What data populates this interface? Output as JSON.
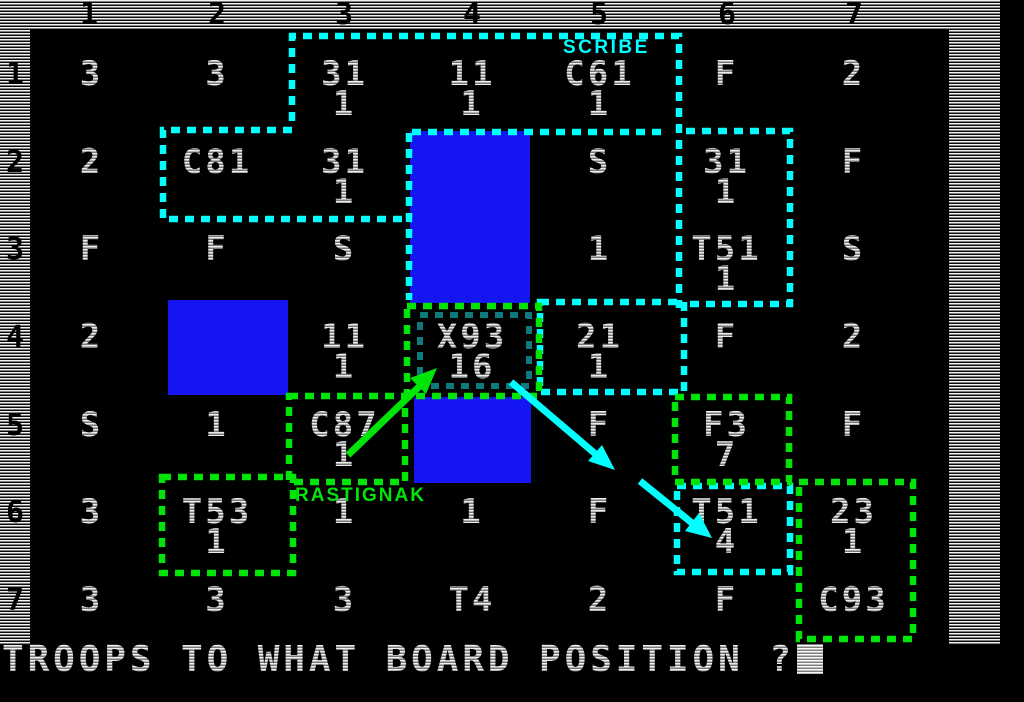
{
  "window": {
    "width": 1024,
    "height": 702
  },
  "game": {
    "prompt": "TROOPS TO WHAT BOARD POSITION ?",
    "cursor_visible": true
  },
  "board": {
    "column_labels": [
      "1",
      "2",
      "3",
      "4",
      "5",
      "6",
      "7"
    ],
    "row_labels": [
      "1",
      "2",
      "3",
      "4",
      "5",
      "6",
      "7"
    ],
    "cells": [
      [
        [
          "3"
        ],
        [
          "3"
        ],
        [
          "31",
          "1"
        ],
        [
          "11",
          "1"
        ],
        [
          "C61",
          "1"
        ],
        [
          "F"
        ],
        [
          "2"
        ]
      ],
      [
        [
          "2"
        ],
        [
          "C81"
        ],
        [
          "31",
          "1"
        ],
        [],
        [
          "S"
        ],
        [
          "31",
          "1"
        ],
        [
          "F"
        ]
      ],
      [
        [
          "F"
        ],
        [
          "F"
        ],
        [
          "S"
        ],
        [],
        [
          "1"
        ],
        [
          "T51",
          "1"
        ],
        [
          "S"
        ]
      ],
      [
        [
          "2"
        ],
        [],
        [
          "11",
          "1"
        ],
        [
          "X93",
          "16"
        ],
        [
          "21",
          "1"
        ],
        [
          "F"
        ],
        [
          "2"
        ]
      ],
      [
        [
          "S"
        ],
        [
          "1"
        ],
        [
          "C87",
          "1"
        ],
        [],
        [
          "F"
        ],
        [
          "F3",
          "7"
        ],
        [
          "F"
        ]
      ],
      [
        [
          "3"
        ],
        [
          "T53",
          "1"
        ],
        [
          "1"
        ],
        [
          "1"
        ],
        [
          "F"
        ],
        [
          "T51",
          "4"
        ],
        [
          "23",
          "1"
        ]
      ],
      [
        [
          "3"
        ],
        [
          "3"
        ],
        [
          "3"
        ],
        [
          "T4"
        ],
        [
          "2"
        ],
        [
          "F"
        ],
        [
          "C93"
        ]
      ]
    ],
    "blue_square_cells": [
      "c4r2-r3",
      "c2r4",
      "c4r5"
    ]
  },
  "players": {
    "cyan": {
      "name": "SCRIBE",
      "color": "#00ffff",
      "outlined_cells": [
        "r1c3-r1c5",
        "r2c2-r2c5",
        "r3c4-r3c5",
        "r2c6-r3c6",
        "r4c5",
        "r6c6"
      ]
    },
    "green": {
      "name": "RASTIGNAK",
      "color": "#00e408",
      "inner_highlight_color": "#0d7a7c",
      "inner_highlight_cell": "r4c4",
      "outlined_cells": [
        "r4c4",
        "r5c3",
        "r6c2",
        "r5c6",
        "r6c7-r7c7"
      ]
    }
  },
  "arrows": [
    {
      "color": "#00e408",
      "from": "RASTIGNAK label",
      "to": "cell r4c4 (X93 16)"
    },
    {
      "color": "#00ffff",
      "from": "cell r4c4 (X93 16)",
      "to": "toward r5c5"
    },
    {
      "color": "#00ffff",
      "from": "between r5c4 and r5c5",
      "to": "cell r6c6 (T51 4)"
    }
  ],
  "colors": {
    "background": "#000000",
    "board_text": "#ededed",
    "ruler_text": "#000000",
    "blue_square": "#1515f2"
  }
}
